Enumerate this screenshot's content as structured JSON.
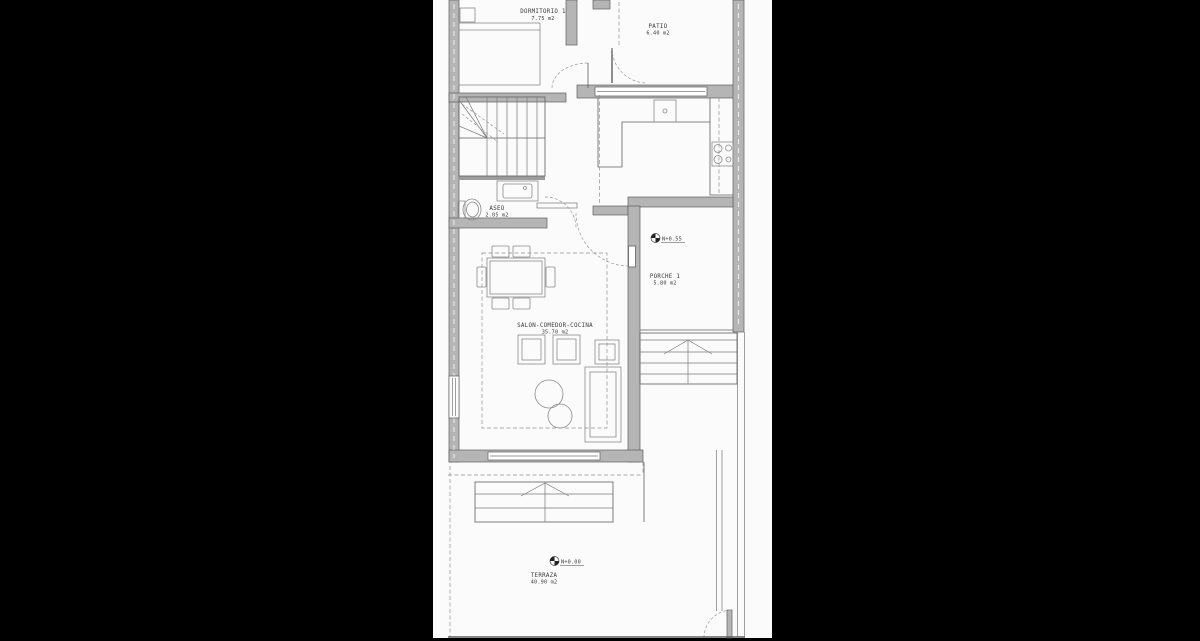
{
  "plan": {
    "title": "floor-plan",
    "rooms": [
      {
        "id": "dormitorio1",
        "name": "DORMITORIO 1",
        "area": "7.75 m2"
      },
      {
        "id": "patio",
        "name": "PATIO",
        "area": "6.40 m2"
      },
      {
        "id": "aseo",
        "name": "ASEO",
        "area": "2.05 m2"
      },
      {
        "id": "salon",
        "name": "SALON-COMEDOR-COCINA",
        "area": "35.70 m2"
      },
      {
        "id": "porche1",
        "name": "PORCHE 1",
        "area": "5.80 m2"
      },
      {
        "id": "terraza",
        "name": "TERRAZA",
        "area": "40.90 m2"
      }
    ],
    "levels": [
      {
        "id": "porche-level",
        "label": "N+0.55"
      },
      {
        "id": "terraza-level",
        "label": "N+0.00"
      }
    ],
    "colors": {
      "background": "#000000",
      "paper": "#fbfbfb",
      "wall_fill": "#b5b5b5",
      "line": "#5f5f5f",
      "text": "#3a3a3a"
    }
  }
}
